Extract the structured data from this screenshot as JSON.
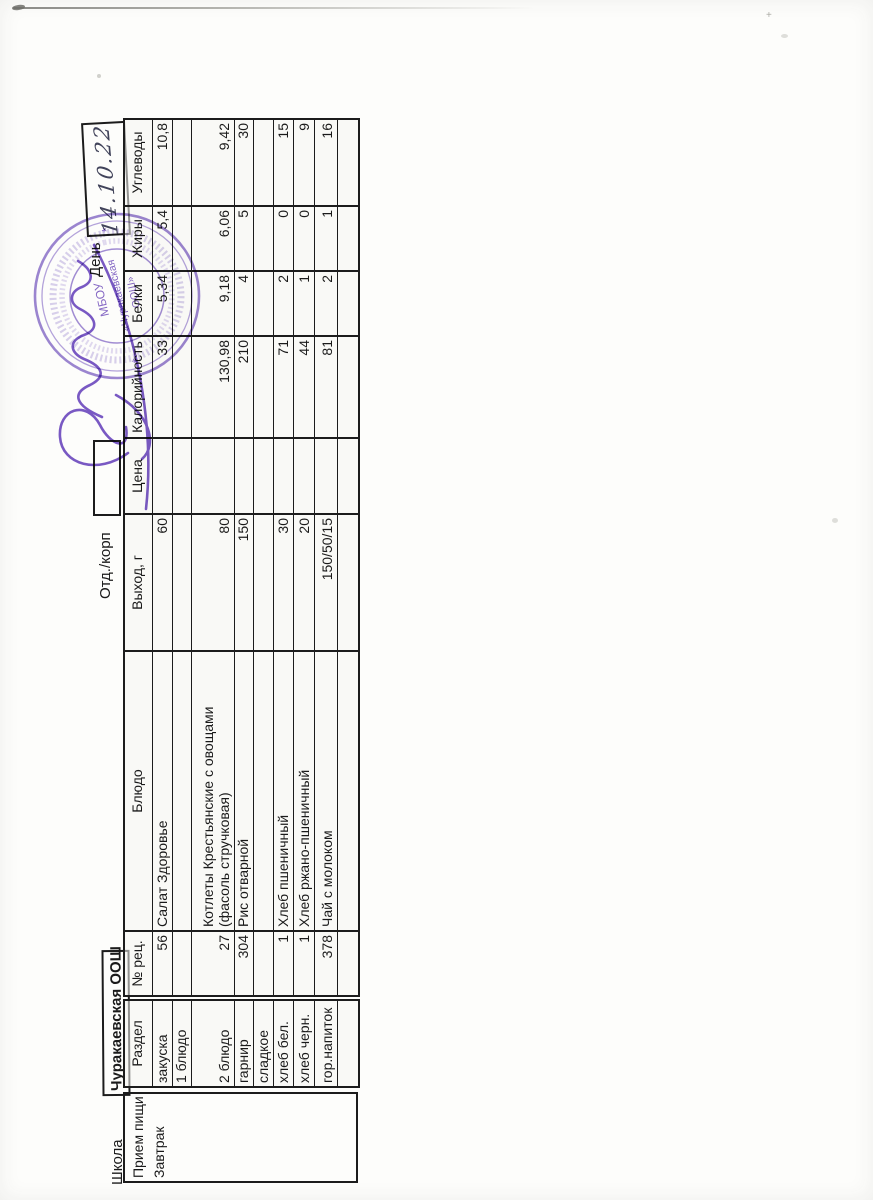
{
  "colors": {
    "paper": "#fdfdfb",
    "table_line": "#1c1c1c",
    "stamp_purple": "#8266c4",
    "signature_purple": "#6b47bd",
    "handwriting_ink": "#41435a"
  },
  "topbar": {
    "school_label": "Школа",
    "school_name": "Чуракаевская ООШ",
    "dept_label": "Отд./корп",
    "day_label": "День",
    "handwritten_date": "14.10.22"
  },
  "stamp": {
    "center_line1": "МБОУ",
    "center_line2": "«Чуракаевская",
    "center_line3": "ООШ»",
    "star_left": "*",
    "star_right": "*"
  },
  "menu_table": {
    "meal_header": "Прием пищи",
    "meal_value": "Завтрак",
    "headers": {
      "razdel": "Раздел",
      "rec": "№ рец.",
      "dish": "Блюдо",
      "out": "Выход, г",
      "price": "Цена",
      "kcal": "Калорийность",
      "protein": "Белки",
      "fat": "Жиры",
      "carbs": "Углеводы"
    },
    "rows": [
      {
        "razdel": "закуска",
        "rec": "56",
        "dish": "Салат Здоровье",
        "out": "60",
        "price": "",
        "kcal": "33",
        "protein": "5,34",
        "fat": "5,4",
        "carbs": "10,8"
      },
      {
        "razdel": "1 блюдо",
        "rec": "",
        "dish": "",
        "out": "",
        "price": "",
        "kcal": "",
        "protein": "",
        "fat": "",
        "carbs": ""
      },
      {
        "razdel": "2 блюдо",
        "rec": "27",
        "dish": "Котлеты Крестьянские с овощами (фасоль стручковая)",
        "out": "80",
        "price": "",
        "kcal": "130,98",
        "protein": "9,18",
        "fat": "6,06",
        "carbs": "9,42"
      },
      {
        "razdel": "гарнир",
        "rec": "304",
        "dish": "Рис отварной",
        "out": "150",
        "price": "",
        "kcal": "210",
        "protein": "4",
        "fat": "5",
        "carbs": "30"
      },
      {
        "razdel": "сладкое",
        "rec": "",
        "dish": "",
        "out": "",
        "price": "",
        "kcal": "",
        "protein": "",
        "fat": "",
        "carbs": ""
      },
      {
        "razdel": "хлеб бел.",
        "rec": "1",
        "dish": "Хлеб пшеничный",
        "out": "30",
        "price": "",
        "kcal": "71",
        "protein": "2",
        "fat": "0",
        "carbs": "15"
      },
      {
        "razdel": "хлеб черн.",
        "rec": "1",
        "dish": "Хлеб ржано-пшеничный",
        "out": "20",
        "price": "",
        "kcal": "44",
        "protein": "1",
        "fat": "0",
        "carbs": "9"
      },
      {
        "razdel": "гор.напиток",
        "rec": "378",
        "dish": "Чай  с молоком",
        "out": "150/50/15",
        "price": "",
        "kcal": "81",
        "protein": "2",
        "fat": "1",
        "carbs": "16"
      },
      {
        "razdel": "",
        "rec": "",
        "dish": "",
        "out": "",
        "price": "",
        "kcal": "",
        "protein": "",
        "fat": "",
        "carbs": ""
      }
    ]
  }
}
